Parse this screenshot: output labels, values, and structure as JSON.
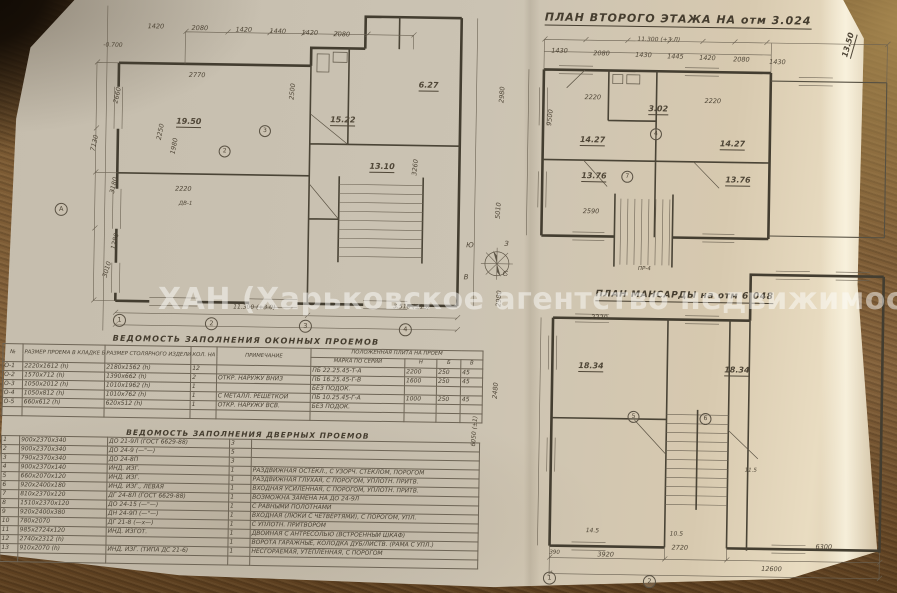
{
  "watermark": "ХАН (Харьковское агентство недвижимости)",
  "titles": {
    "second_floor": "ПЛАН ВТОРОГО ЭТАЖА НА отм 3.024",
    "mansard": "ПЛАН МАНСАРДЫ на отм 6.048",
    "windows_table": "ВЕДОМОСТЬ ЗАПОЛНЕНИЯ ОКОННЫХ ПРОЕМОВ",
    "doors_table": "ВЕДОМОСТЬ ЗАПОЛНЕНИЯ ДВЕРНЫХ ПРОЕМОВ"
  },
  "tables": {
    "windows": {
      "group_header": "ПОЛОЖЕННАЯ ПЛИТА НА ПРОЕМ",
      "headers": [
        "№",
        "РАЗМЕР ПРОЕМА В КЛАДКЕ БЕЗ ЧЕТВ.",
        "РАЗМЕР СТОЛЯРНОГО ИЗДЕЛИЯ",
        "КОЛ. НА ДОМ",
        "ПРИМЕЧАНИЕ",
        "МАРКА ПО СЕРИИ",
        "Н",
        "Б",
        "В"
      ],
      "rows": [
        [
          "О-1",
          "2220х1612 (h)",
          "2180х1562 (h)",
          "12",
          "",
          "ПБ 22.25.45-Т-А",
          "2200",
          "250",
          "45"
        ],
        [
          "О-2",
          "1570х712 (h)",
          "1390х662 (h)",
          "2",
          "ОТКР. НАРУЖУ ВНИЗ",
          "ПБ 16.25.45-Г-В",
          "1600",
          "250",
          "45"
        ],
        [
          "О-3",
          "1050х2012 (h)",
          "1010х1962 (h)",
          "1",
          "",
          "БЕЗ ПОДОК.",
          "",
          "",
          ""
        ],
        [
          "О-4",
          "1050х812 (h)",
          "1010х762 (h)",
          "1",
          "С МЕТАЛЛ. РЕШЕТКОЙ",
          "ПБ 10.25.45-Г-А",
          "1000",
          "250",
          "45"
        ],
        [
          "О-5",
          "660х612 (h)",
          "620х512 (h)",
          "1",
          "ОТКР. НАРУЖУ ВСВ.",
          "БЕЗ ПОДОК.",
          "",
          "",
          ""
        ],
        [
          "",
          "",
          "",
          "",
          "",
          "",
          "",
          "",
          ""
        ]
      ]
    },
    "doors": {
      "rows": [
        [
          "1",
          "900х2370х340",
          "ДО 21-9Л (ГОСТ 6629-88)",
          "3",
          ""
        ],
        [
          "2",
          "900х2370х340",
          "ДО 24-9 (—\"—)",
          "5",
          ""
        ],
        [
          "3",
          "790х2370х340",
          "ДО 24-8П",
          "3",
          ""
        ],
        [
          "4",
          "900х2370х140",
          "ИНД. ИЗГ.",
          "1",
          "РАЗДВИЖНАЯ ОСТЕКЛ., С УЗОРЧ. СТЕКЛОМ, ПОРОГОМ"
        ],
        [
          "5",
          "660х2070х120",
          "ИНД. ИЗГ.",
          "1",
          "РАЗДВИЖНАЯ ГЛУХАЯ, С ПОРОГОМ, УПЛОТН. ПРИТВ."
        ],
        [
          "6",
          "920х2400х180",
          "ИНД. ИЗГ., ЛЕВАЯ",
          "1",
          "ВХОДНАЯ УСИЛЕННАЯ, С ПОРОГОМ, УПЛОТН. ПРИТВ."
        ],
        [
          "7",
          "810х2370х120",
          "ДГ 24-8Л (ГОСТ 6629-88)",
          "1",
          "ВОЗМОЖНА ЗАМЕНА НА ДО 24-9Л"
        ],
        [
          "8",
          "1510х2370х120",
          "ДО 24-15 (—\"—)",
          "1",
          "С РАВНЫМИ ПОЛОТНАМИ"
        ],
        [
          "9",
          "920х2400х380",
          "ДН 24-9П (—\"—)",
          "1",
          "ВХОДНАЯ (ЛЮКИ С ЧЕТВЕРТЯМИ), С ПОРОГОМ, УПЛ."
        ],
        [
          "10",
          "780х2070",
          "ДГ 21-8 (—х—)",
          "1",
          "С УПЛОТН. ПРИТВОРОМ"
        ],
        [
          "11",
          "985х2724х120",
          "ИНД. ИЗГОТ.",
          "1",
          "ДВОЙНАЯ С АНТРЕСОЛЬЮ (ВСТРОЕННЫЙ ШКАФ)"
        ],
        [
          "12",
          "2740х2312 (h)",
          "",
          "1",
          "ВОРОТА ГАРАЖНЫЕ, КОЛОДКА ДУБ/ЛИСТВ. (РАМА С УПЛ.)"
        ],
        [
          "13",
          "910х2070 (h)",
          "ИНД. ИЗГ. (ТИПА ДС 21-6)",
          "1",
          "НЕСГОРАЕМАЯ, УТЕПЛЕННАЯ, С ПОРОГОМ"
        ],
        [
          "",
          "",
          "",
          "",
          ""
        ]
      ]
    }
  },
  "labels": [
    {
      "t": "-0.700",
      "x": 104,
      "y": 42,
      "s": 6
    },
    {
      "t": "1420",
      "x": 148,
      "y": 22
    },
    {
      "t": "2080",
      "x": 192,
      "y": 23
    },
    {
      "t": "1420",
      "x": 236,
      "y": 24
    },
    {
      "t": "1440",
      "x": 270,
      "y": 25
    },
    {
      "t": "1420",
      "x": 302,
      "y": 26
    },
    {
      "t": "2080",
      "x": 334,
      "y": 27
    },
    {
      "t": "2770",
      "x": 190,
      "y": 70
    },
    {
      "t": "19.50",
      "x": 178,
      "y": 116,
      "cls": "room"
    },
    {
      "t": "2250",
      "x": 158,
      "y": 138,
      "r": 80
    },
    {
      "t": "1980",
      "x": 172,
      "y": 152,
      "r": 80
    },
    {
      "t": "2220",
      "x": 178,
      "y": 184
    },
    {
      "t": "ДВ-1",
      "x": 182,
      "y": 200,
      "s": 5.5
    },
    {
      "t": "15.22",
      "x": 332,
      "y": 112,
      "cls": "room"
    },
    {
      "t": "13.10",
      "x": 372,
      "y": 158,
      "cls": "room"
    },
    {
      "t": "6.27",
      "x": 420,
      "y": 76,
      "cls": "room"
    },
    {
      "t": "2500",
      "x": 290,
      "y": 96,
      "r": 85
    },
    {
      "t": "3260",
      "x": 414,
      "y": 170,
      "r": 85
    },
    {
      "t": "7130",
      "x": 92,
      "y": 150,
      "r": 78
    },
    {
      "t": "2660",
      "x": 114,
      "y": 102,
      "r": 78
    },
    {
      "t": "3180",
      "x": 112,
      "y": 192,
      "r": 78
    },
    {
      "t": "1280",
      "x": 114,
      "y": 248,
      "r": 78
    },
    {
      "t": "3010",
      "x": 106,
      "y": 276,
      "r": 75
    },
    {
      "t": "11.300 (+3.0)",
      "x": 238,
      "y": 302,
      "s": 6
    },
    {
      "t": "3.510 (±15)",
      "x": 398,
      "y": 299,
      "s": 6
    },
    {
      "t": "2980",
      "x": 500,
      "y": 96,
      "r": 87
    },
    {
      "t": "5010",
      "x": 498,
      "y": 212,
      "r": 87
    },
    {
      "t": "2980",
      "x": 500,
      "y": 300,
      "r": 87
    },
    {
      "t": "2480",
      "x": 498,
      "y": 392,
      "r": 87
    },
    {
      "t": "6050 (±1)",
      "x": 478,
      "y": 440,
      "r": 87,
      "s": 6
    },
    {
      "t": "1",
      "x": 118,
      "y": 313,
      "cls": "axis"
    },
    {
      "t": "2",
      "x": 210,
      "y": 315,
      "cls": "axis"
    },
    {
      "t": "3",
      "x": 304,
      "y": 316,
      "cls": "axis"
    },
    {
      "t": "4",
      "x": 404,
      "y": 318,
      "cls": "axis"
    },
    {
      "t": "А",
      "x": 58,
      "y": 203,
      "cls": "axis"
    },
    {
      "t": "2",
      "x": 221,
      "y": 143,
      "cls": "mark"
    },
    {
      "t": "3",
      "x": 261,
      "y": 122,
      "cls": "mark"
    },
    {
      "t": "Ю",
      "x": 470,
      "y": 236,
      "s": 7
    },
    {
      "t": "З",
      "x": 508,
      "y": 234,
      "s": 7
    },
    {
      "t": "С",
      "x": 507,
      "y": 264,
      "s": 7
    },
    {
      "t": "В",
      "x": 468,
      "y": 268,
      "s": 7
    },
    {
      "t": "11.300 (+3.Л)",
      "x": 638,
      "y": 28,
      "s": 6
    },
    {
      "t": "1430",
      "x": 552,
      "y": 40
    },
    {
      "t": "2080",
      "x": 594,
      "y": 42
    },
    {
      "t": "1430",
      "x": 636,
      "y": 43
    },
    {
      "t": "1445",
      "x": 668,
      "y": 44
    },
    {
      "t": "1420",
      "x": 700,
      "y": 45
    },
    {
      "t": "2080",
      "x": 734,
      "y": 46
    },
    {
      "t": "1430",
      "x": 770,
      "y": 48
    },
    {
      "t": "2220",
      "x": 586,
      "y": 86
    },
    {
      "t": "2220",
      "x": 706,
      "y": 88
    },
    {
      "t": "14.27",
      "x": 582,
      "y": 128,
      "cls": "room"
    },
    {
      "t": "3.02",
      "x": 650,
      "y": 96,
      "cls": "room"
    },
    {
      "t": "14.27",
      "x": 722,
      "y": 130,
      "cls": "room"
    },
    {
      "t": "13.76",
      "x": 584,
      "y": 164,
      "cls": "room"
    },
    {
      "t": "13.76",
      "x": 728,
      "y": 166,
      "cls": "room"
    },
    {
      "t": "9500",
      "x": 548,
      "y": 118,
      "r": 85
    },
    {
      "t": "2590",
      "x": 586,
      "y": 200
    },
    {
      "t": "ПР-4",
      "x": 642,
      "y": 258,
      "s": 5.5
    },
    {
      "t": "4",
      "x": 652,
      "y": 119,
      "cls": "mark"
    },
    {
      "t": "7",
      "x": 624,
      "y": 162,
      "cls": "mark"
    },
    {
      "t": "13.50",
      "x": 842,
      "y": 44,
      "r": 75,
      "cls": "room"
    },
    {
      "t": "18.34",
      "x": 584,
      "y": 354,
      "cls": "room"
    },
    {
      "t": "18.34",
      "x": 730,
      "y": 356,
      "cls": "room"
    },
    {
      "t": "11.5",
      "x": 752,
      "y": 458,
      "s": 5.5
    },
    {
      "t": "5",
      "x": 634,
      "y": 402,
      "cls": "mark"
    },
    {
      "t": "6",
      "x": 706,
      "y": 403,
      "cls": "mark"
    },
    {
      "t": "2220",
      "x": 596,
      "y": 306
    },
    {
      "t": "14.5",
      "x": 594,
      "y": 520,
      "s": 6
    },
    {
      "t": "10.5",
      "x": 678,
      "y": 522,
      "s": 6
    },
    {
      "t": "390",
      "x": 558,
      "y": 543,
      "s": 5.5
    },
    {
      "t": "3920",
      "x": 606,
      "y": 543
    },
    {
      "t": "2720",
      "x": 680,
      "y": 535
    },
    {
      "t": "6300",
      "x": 824,
      "y": 532
    },
    {
      "t": "12600",
      "x": 770,
      "y": 555
    },
    {
      "t": "1",
      "x": 552,
      "y": 564,
      "cls": "axis"
    },
    {
      "t": "2",
      "x": 652,
      "y": 566,
      "cls": "axis"
    }
  ]
}
